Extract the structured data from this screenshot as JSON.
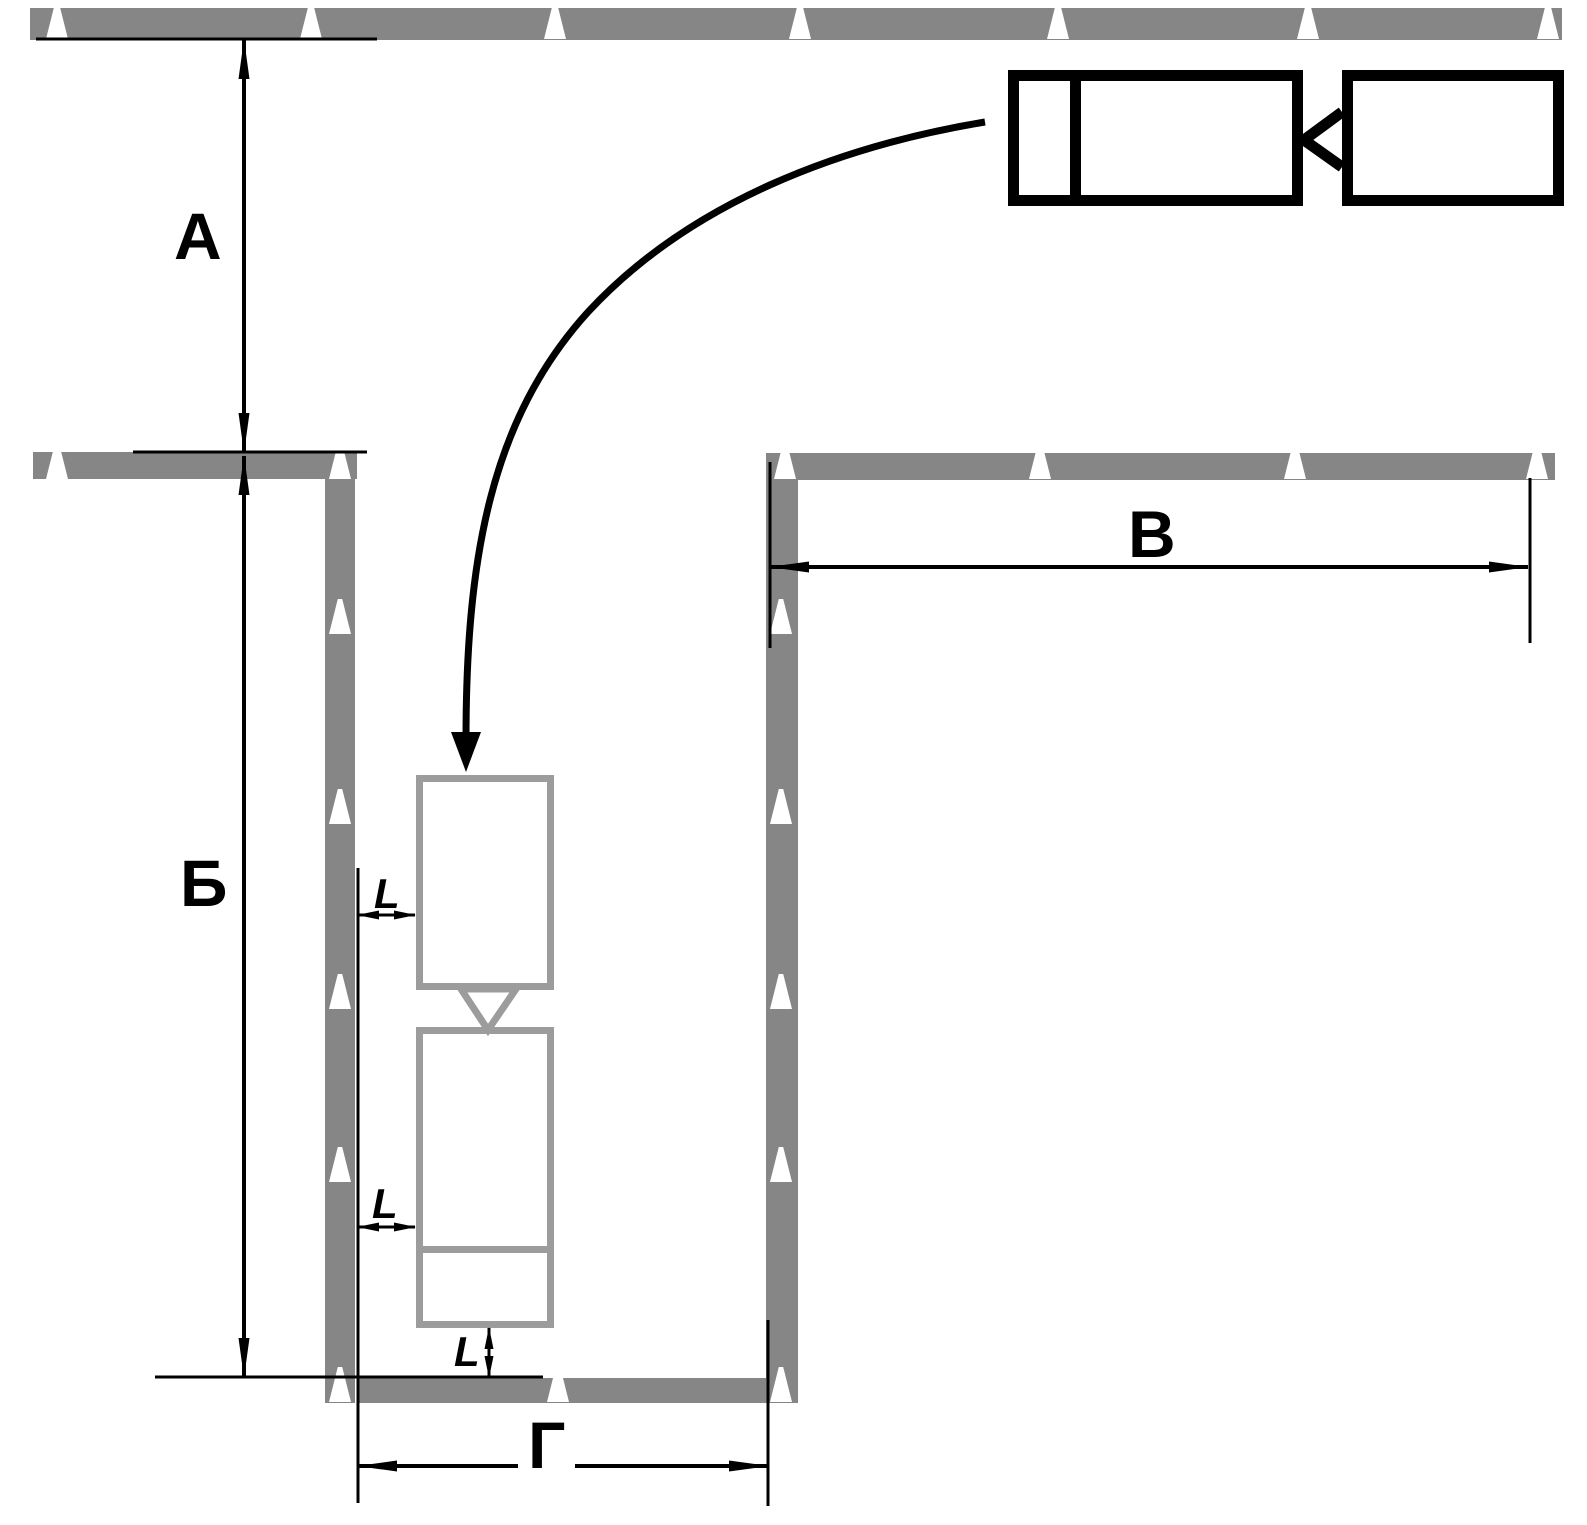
{
  "diagram_type": "driving-course-reverse-parking-scheme",
  "labels": {
    "dim_approach_depth": "А",
    "dim_bay_length": "Б",
    "dim_right_lane": "В",
    "dim_bay_width": "Г",
    "clearance_trailer_side": "L",
    "clearance_truck_side": "L",
    "clearance_rear": "L"
  },
  "icons": {
    "cone": "traffic-cone",
    "trajectory": "curved-reversing-path-arrow"
  },
  "colors": {
    "bg": "#ffffff",
    "wall": "#868686",
    "vehicle": "#9c9c9c",
    "line": "#000000",
    "cone": "#ffffff"
  }
}
